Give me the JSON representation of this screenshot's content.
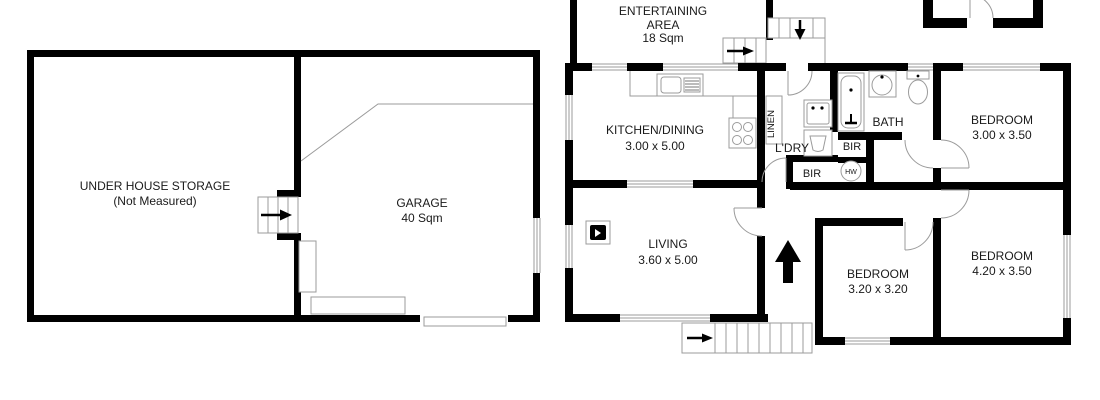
{
  "colors": {
    "wall": "#000000",
    "thin_line": "#9b9b9b",
    "background": "#ffffff",
    "text": "#1a1a1a"
  },
  "left": {
    "storage": {
      "line1": "UNDER HOUSE STORAGE",
      "line2": "(Not Measured)"
    },
    "garage": {
      "line1": "GARAGE",
      "line2": "40 Sqm"
    }
  },
  "right": {
    "entertaining": {
      "line1": "ENTERTAINING",
      "line2": "AREA",
      "line3": "18 Sqm"
    },
    "kitchen": {
      "line1": "KITCHEN/DINING",
      "line2": "3.00 x 5.00"
    },
    "linen": "LINEN",
    "ldry": "L'DRY",
    "bath": "BATH",
    "bir_upper": "BIR",
    "bir_lower": "BIR",
    "hw": "HW",
    "living": {
      "line1": "LIVING",
      "line2": "3.60 x 5.00"
    },
    "bedroom1": {
      "line1": "BEDROOM",
      "line2": "3.00 x 3.50"
    },
    "bedroom2": {
      "line1": "BEDROOM",
      "line2": "4.20 x 3.50"
    },
    "bedroom3": {
      "line1": "BEDROOM",
      "line2": "3.20 x 3.20"
    }
  }
}
